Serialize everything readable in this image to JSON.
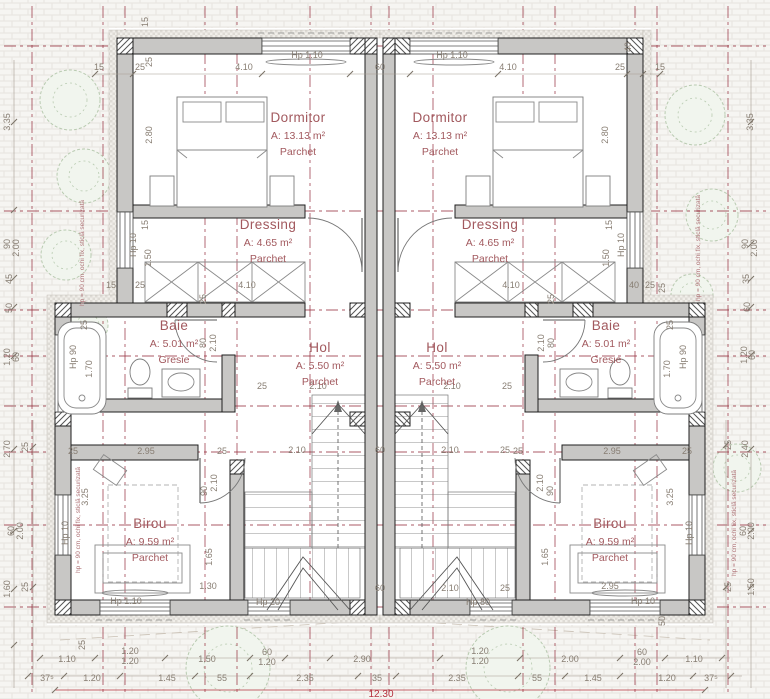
{
  "colors": {
    "axis": "#96303e",
    "wall": "#c8c7c5",
    "label": "#a2595e",
    "dim": "#877d72",
    "total": "#b5323e",
    "tree": "#b9cbb1"
  },
  "rooms": [
    {
      "name": "Dormitor",
      "area": "A: 13.13 m²",
      "floor": "Parchet",
      "x": 298,
      "y": 122
    },
    {
      "name": "Dormitor",
      "area": "A: 13.13 m²",
      "floor": "Parchet",
      "x": 440,
      "y": 122
    },
    {
      "name": "Dressing",
      "area": "A: 4.65 m²",
      "floor": "Parchet",
      "x": 268,
      "y": 229
    },
    {
      "name": "Dressing",
      "area": "A: 4.65 m²",
      "floor": "Parchet",
      "x": 490,
      "y": 229
    },
    {
      "name": "Baie",
      "area": "A: 5.01 m²",
      "floor": "Gresie",
      "x": 174,
      "y": 330
    },
    {
      "name": "Baie",
      "area": "A: 5.01 m²",
      "floor": "Gresie",
      "x": 606,
      "y": 330
    },
    {
      "name": "Hol",
      "area": "A: 5.50 m²",
      "floor": "Parchet",
      "x": 320,
      "y": 352
    },
    {
      "name": "Hol",
      "area": "A: 5.50 m²",
      "floor": "Parchet",
      "x": 437,
      "y": 352
    },
    {
      "name": "Birou",
      "area": "A: 9.59 m²",
      "floor": "Parchet",
      "x": 150,
      "y": 528
    },
    {
      "name": "Birou",
      "area": "A: 9.59 m²",
      "floor": "Parchet",
      "x": 610,
      "y": 528
    }
  ],
  "total": {
    "t": "12.30"
  },
  "notes": [
    {
      "t": "hp = 90 cm, ochi fix, sticlă securizată",
      "x": 84,
      "y": 253
    },
    {
      "t": "hp = 90 cm, ochi fix, sticlă securizată",
      "x": 80,
      "y": 520
    },
    {
      "t": "hp = 90 cm, ochi fix, sticlă securizată",
      "x": 700,
      "y": 248
    },
    {
      "t": "hp = 90 cm, ochi fix, sticlă securizată",
      "x": 736,
      "y": 523
    }
  ],
  "dims": [
    [
      "15",
      148,
      22,
      1
    ],
    [
      "25",
      152,
      62,
      1
    ],
    [
      "15",
      99,
      70,
      0
    ],
    [
      "25",
      140,
      70,
      0
    ],
    [
      "4.10",
      244,
      70,
      0
    ],
    [
      "Hp 1.10",
      307,
      58,
      0
    ],
    [
      "60",
      380,
      70,
      0
    ],
    [
      "Hp 1.10",
      452,
      58,
      0
    ],
    [
      "4.10",
      508,
      70,
      0
    ],
    [
      "25",
      620,
      70,
      0
    ],
    [
      "15",
      660,
      70,
      0
    ],
    [
      "40",
      631,
      47,
      1
    ],
    [
      "2.80",
      152,
      135,
      1
    ],
    [
      "2.80",
      608,
      135,
      1
    ],
    [
      "3.35",
      10,
      122,
      1
    ],
    [
      "3.35",
      753,
      122,
      1
    ],
    [
      "15",
      148,
      225,
      1
    ],
    [
      "Hp 10",
      136,
      245,
      1
    ],
    [
      "1.50",
      151,
      258,
      1
    ],
    [
      "15",
      111,
      288,
      0
    ],
    [
      "25",
      140,
      288,
      0
    ],
    [
      "4.10",
      247,
      288,
      0
    ],
    [
      "25",
      206,
      299,
      1
    ],
    [
      "15",
      612,
      225,
      1
    ],
    [
      "Hp 10",
      624,
      245,
      1
    ],
    [
      "1.50",
      609,
      258,
      1
    ],
    [
      "4.10",
      511,
      288,
      0
    ],
    [
      "40",
      634,
      288,
      0
    ],
    [
      "25",
      650,
      288,
      0
    ],
    [
      "25",
      554,
      299,
      1
    ],
    [
      "25",
      665,
      288,
      1
    ],
    [
      "25",
      87,
      325,
      1
    ],
    [
      "Hp 90",
      76,
      357,
      1
    ],
    [
      "1.70",
      92,
      369,
      1
    ],
    [
      "80",
      206,
      343,
      1
    ],
    [
      "2.10",
      216,
      343,
      1
    ],
    [
      "25",
      673,
      325,
      1
    ],
    [
      "Hp 90",
      686,
      357,
      1
    ],
    [
      "1.70",
      670,
      369,
      1
    ],
    [
      "80",
      554,
      343,
      1
    ],
    [
      "2.10",
      544,
      343,
      1
    ],
    [
      "2.10",
      318,
      389,
      0
    ],
    [
      "25",
      262,
      389,
      0
    ],
    [
      "2.10",
      452,
      389,
      0
    ],
    [
      "25",
      507,
      389,
      0
    ],
    [
      "2.10",
      297,
      453,
      0
    ],
    [
      "60",
      380,
      453,
      0
    ],
    [
      "2.10",
      450,
      453,
      0
    ],
    [
      "25",
      505,
      453,
      0
    ],
    [
      "60",
      380,
      591,
      0
    ],
    [
      "2.10",
      450,
      591,
      0
    ],
    [
      "25",
      505,
      591,
      0
    ],
    [
      "Hp 20",
      268,
      605,
      0
    ],
    [
      "Hp 80",
      478,
      605,
      0
    ],
    [
      "1.30",
      208,
      589,
      0
    ],
    [
      "2.95",
      610,
      589,
      0
    ],
    [
      "25",
      73,
      454,
      0
    ],
    [
      "2.95",
      146,
      454,
      0
    ],
    [
      "25",
      222,
      454,
      0
    ],
    [
      "25",
      518,
      454,
      0
    ],
    [
      "2.95",
      612,
      454,
      0
    ],
    [
      "25",
      687,
      454,
      0
    ],
    [
      "3.25",
      88,
      497,
      1
    ],
    [
      "3.25",
      673,
      497,
      1
    ],
    [
      "90",
      207,
      491,
      1
    ],
    [
      "2.10",
      217,
      483,
      1
    ],
    [
      "90",
      553,
      491,
      1
    ],
    [
      "2.10",
      543,
      483,
      1
    ],
    [
      "1.65",
      212,
      557,
      1
    ],
    [
      "1.65",
      548,
      557,
      1
    ],
    [
      "Hp 10",
      68,
      533,
      1
    ],
    [
      "Hp 10",
      692,
      533,
      1
    ],
    [
      "Hp 1.10",
      126,
      604,
      0
    ],
    [
      "Hp 10",
      643,
      604,
      0
    ],
    [
      "50",
      665,
      621,
      1
    ],
    [
      "25",
      85,
      645,
      1
    ],
    [
      "90",
      10,
      244,
      1
    ],
    [
      "2.00",
      19,
      248,
      1
    ],
    [
      "45",
      12,
      279,
      1
    ],
    [
      "50",
      12,
      308,
      1
    ],
    [
      "1.20",
      10,
      357,
      1
    ],
    [
      "60",
      19,
      357,
      1
    ],
    [
      "2.70",
      10,
      449,
      1
    ],
    [
      "25",
      28,
      447,
      1
    ],
    [
      "60",
      14,
      531,
      1
    ],
    [
      "2.00",
      23,
      531,
      1
    ],
    [
      "1.60",
      10,
      589,
      1
    ],
    [
      "25",
      28,
      587,
      1
    ],
    [
      "90",
      748,
      244,
      1
    ],
    [
      "2.00",
      757,
      248,
      1
    ],
    [
      "35",
      749,
      279,
      1
    ],
    [
      "60",
      750,
      307,
      1
    ],
    [
      "1.20",
      747,
      355,
      1
    ],
    [
      "60",
      755,
      355,
      1
    ],
    [
      "2.40",
      748,
      449,
      1
    ],
    [
      "25",
      731,
      445,
      1
    ],
    [
      "60",
      746,
      531,
      1
    ],
    [
      "2.00",
      754,
      531,
      1
    ],
    [
      "1.50",
      754,
      587,
      1
    ],
    [
      "25",
      731,
      587,
      1
    ],
    [
      "1.10",
      67,
      662,
      0
    ],
    [
      "1.20",
      130,
      654,
      0
    ],
    [
      "1.20",
      130,
      664,
      0
    ],
    [
      "1.50",
      207,
      662,
      0
    ],
    [
      "60",
      267,
      655,
      0
    ],
    [
      "1.20",
      267,
      665,
      0
    ],
    [
      "2.90",
      362,
      662,
      0
    ],
    [
      "1.20",
      480,
      654,
      0
    ],
    [
      "1.20",
      480,
      664,
      0
    ],
    [
      "2.00",
      570,
      662,
      0
    ],
    [
      "60",
      642,
      655,
      0
    ],
    [
      "2.00",
      642,
      665,
      0
    ],
    [
      "1.10",
      694,
      662,
      0
    ],
    [
      "37⁵",
      47,
      681,
      0
    ],
    [
      "1.20",
      92,
      681,
      0
    ],
    [
      "1.45",
      167,
      681,
      0
    ],
    [
      "55",
      222,
      681,
      0
    ],
    [
      "2.35",
      305,
      681,
      0
    ],
    [
      "35",
      377,
      681,
      0
    ],
    [
      "2.35",
      457,
      681,
      0
    ],
    [
      "55",
      537,
      681,
      0
    ],
    [
      "1.45",
      593,
      681,
      0
    ],
    [
      "1.20",
      667,
      681,
      0
    ],
    [
      "37⁵",
      711,
      681,
      0
    ]
  ],
  "ticks": [
    [
      95,
      74
    ],
    [
      133,
      74
    ],
    [
      262,
      74
    ],
    [
      350,
      74
    ],
    [
      410,
      74
    ],
    [
      498,
      74
    ],
    [
      627,
      74
    ],
    [
      643,
      74
    ],
    [
      660,
      74
    ],
    [
      40,
      658
    ],
    [
      95,
      658
    ],
    [
      165,
      658
    ],
    [
      250,
      658
    ],
    [
      285,
      658
    ],
    [
      330,
      658
    ],
    [
      440,
      658
    ],
    [
      520,
      658
    ],
    [
      620,
      658
    ],
    [
      665,
      658
    ],
    [
      722,
      658
    ],
    [
      28,
      676
    ],
    [
      64,
      676
    ],
    [
      120,
      676
    ],
    [
      195,
      676
    ],
    [
      250,
      676
    ],
    [
      358,
      676
    ],
    [
      396,
      676
    ],
    [
      518,
      676
    ],
    [
      565,
      676
    ],
    [
      620,
      676
    ],
    [
      693,
      676
    ],
    [
      731,
      676
    ],
    [
      55,
      690
    ],
    [
      705,
      690
    ],
    [
      14,
      122
    ],
    [
      14,
      210
    ],
    [
      14,
      278
    ],
    [
      14,
      307
    ],
    [
      14,
      356
    ],
    [
      14,
      449
    ],
    [
      14,
      531
    ],
    [
      14,
      589
    ],
    [
      14,
      645
    ],
    [
      33,
      447
    ],
    [
      33,
      587
    ],
    [
      751,
      122
    ],
    [
      751,
      244
    ],
    [
      751,
      279
    ],
    [
      751,
      307
    ],
    [
      751,
      355
    ],
    [
      751,
      449
    ],
    [
      751,
      531
    ],
    [
      751,
      587
    ],
    [
      726,
      445
    ],
    [
      726,
      587
    ]
  ]
}
